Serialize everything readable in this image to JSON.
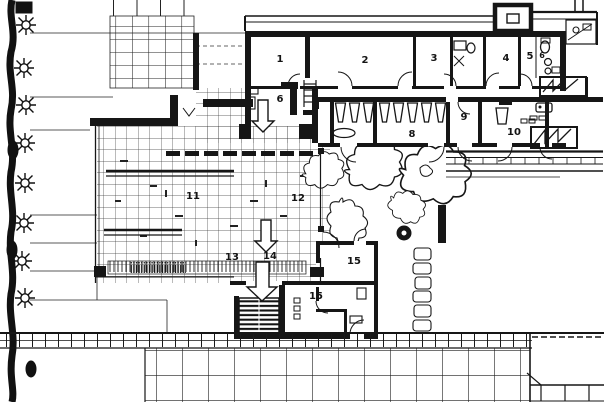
{
  "colors": {
    "ink": "#161616",
    "paper": "#ffffff"
  },
  "plan": {
    "room_labels": [
      "1",
      "2",
      "3",
      "4",
      "5",
      "6",
      "6",
      "8",
      "9",
      "10",
      "11",
      "12",
      "13",
      "14",
      "15",
      "15"
    ]
  },
  "icons": {
    "tree": "spiked-circle-tree",
    "bush": "wobbly-outline-shrub",
    "stairs": "treaded-stair-block",
    "down-arrow": "hollow-block-arrow",
    "door": "quarter-arc-swing"
  }
}
